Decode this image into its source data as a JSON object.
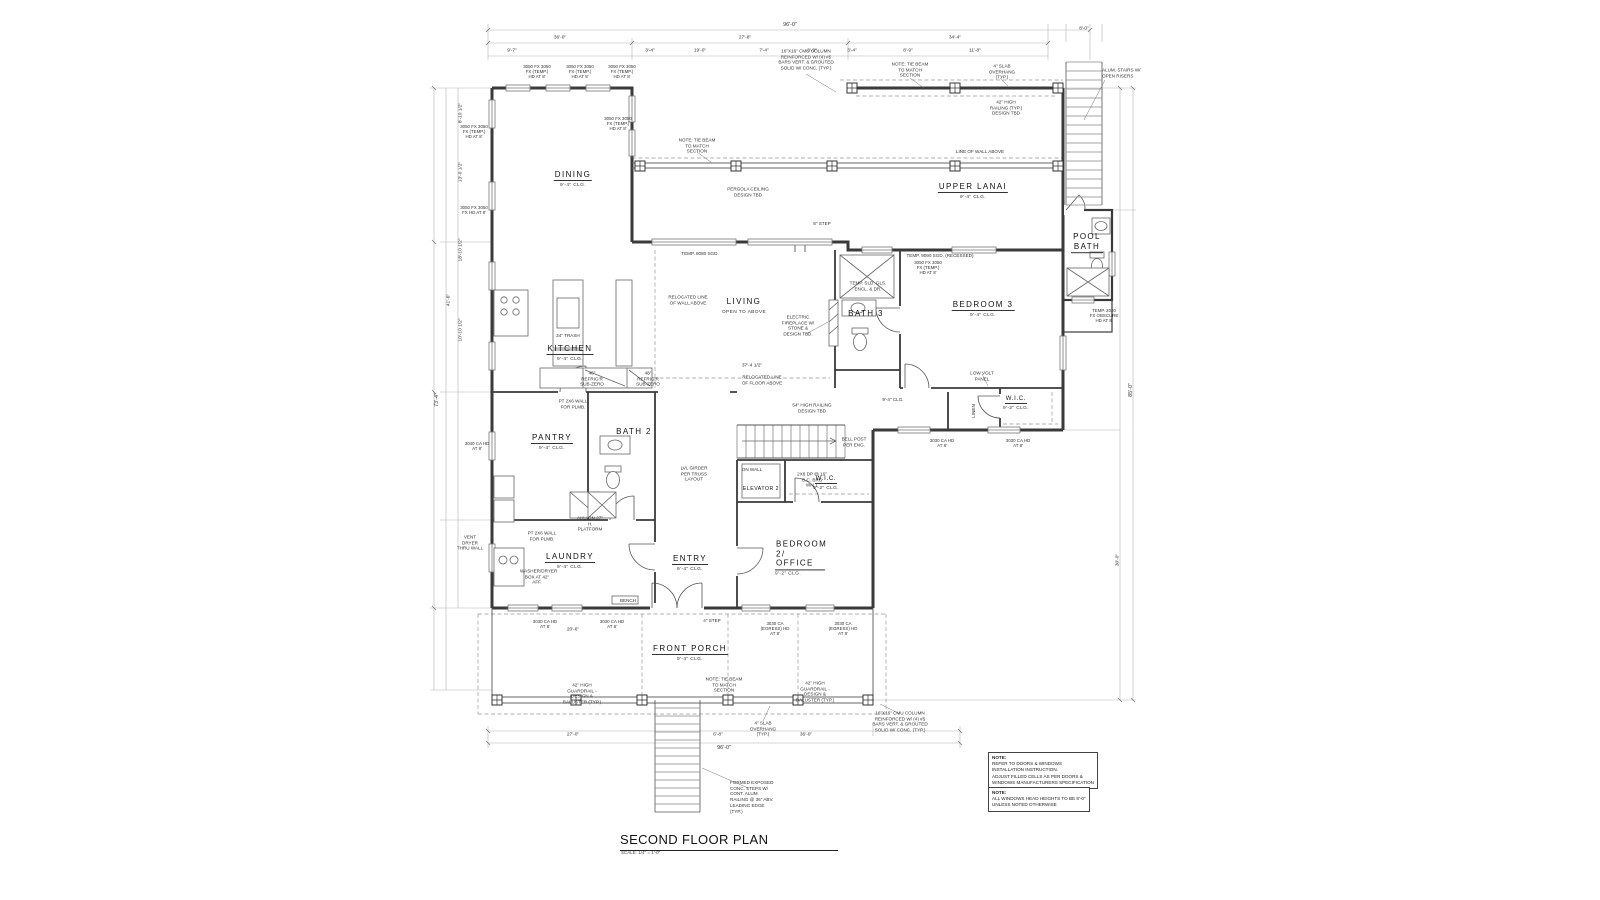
{
  "sheet": {
    "title": "SECOND FLOOR PLAN",
    "scale": "SCALE: 1/4\" = 1'-0\""
  },
  "notes": [
    {
      "heading": "NOTE:",
      "line1": "REFER TO DOORS & WINDOWS INSTALLATION INSTRUCTION.",
      "line2": "ADJUST FILLED CELLS AS PER DOORS & WINDOWS MANUFACTURERS SPECIFICATION"
    },
    {
      "heading": "NOTE:",
      "line1": "ALL WINDOWS HEAD HEIGHTS TO BE 8'-0\" UNLESS NOTED OTHERWISE",
      "line2": ""
    }
  ],
  "rooms": [
    {
      "name": "DINING",
      "detail": "9'-4\" CLG."
    },
    {
      "name": "UPPER LANAI",
      "detail": "9'-4\" CLG."
    },
    {
      "name": "POOL BATH",
      "detail": ""
    },
    {
      "name": "LIVING",
      "detail": "OPEN TO ABOVE"
    },
    {
      "name": "BATH 3",
      "detail": ""
    },
    {
      "name": "BEDROOM 3",
      "detail": "9'-4\" CLG."
    },
    {
      "name": "KITCHEN",
      "detail": "9'-4\" CLG."
    },
    {
      "name": "PANTRY",
      "detail": "9'-4\" CLG."
    },
    {
      "name": "BATH 2",
      "detail": ""
    },
    {
      "name": "LAUNDRY",
      "detail": "9'-4\" CLG."
    },
    {
      "name": "ENTRY",
      "detail": "9'-4\" CLG."
    },
    {
      "name": "ELEVATOR 2",
      "detail": ""
    },
    {
      "name": "W.I.C.",
      "detail": "9'-2\" CLG."
    },
    {
      "name": "BEDROOM 2/ OFFICE",
      "detail": "9'-2\" CLG."
    },
    {
      "name": "W.I.C.",
      "detail": "9'-2\" CLG."
    },
    {
      "name": "FRONT PORCH",
      "detail": "9'-4\" CLG."
    }
  ],
  "annotations": [
    {
      "text": "ALUM. STAIRS W/ OPEN RISERS"
    },
    {
      "text": "16\"X16\" CMU COLUMN REINFORCED W/ (4) #5 BARS VERT. & GROUTED SOLID W/ CONC. (TYP.)"
    },
    {
      "text": "NOTE: TIE BEAM TO MATCH SECTION"
    },
    {
      "text": "4\" SLAB OVERHANG (TYP.)"
    },
    {
      "text": "42\" HIGH RAILING (TYP.) DESIGN TBD"
    },
    {
      "text": "PERGOLA CEILING DESIGN TBD"
    },
    {
      "text": "LINE OF WALL ABOVE"
    },
    {
      "text": "8\" STEP"
    },
    {
      "text": "TEMP. 8080 SGD."
    },
    {
      "text": "TEMP. 9090 SGD. (RECESSED)"
    },
    {
      "text": "RELOCATED LINE OF WALL ABOVE"
    },
    {
      "text": "RELOCATED LINE OF FLOOR ABOVE"
    },
    {
      "text": "ELECTRIC FIREPLACE W/ STONE & DESIGN TBD."
    },
    {
      "text": "TEMP. SLD. GLS. ENCL. & DR."
    },
    {
      "text": "LOW VOLT PANEL"
    },
    {
      "text": "LINEN"
    },
    {
      "text": "54\" HIGH RAILING DESIGN TBD"
    },
    {
      "text": "BELL POST PER ENG."
    },
    {
      "text": "ON WALL"
    },
    {
      "text": "LVL GIRDER PER TRUSS LAYOUT"
    },
    {
      "text": "2X6 DP @ 16\" O.C. BRG WALL"
    },
    {
      "text": "AHU ON 27\" H. PLATFORM"
    },
    {
      "text": "PT 2X6 WALL FOR PLMB."
    },
    {
      "text": "VENT DRYER THRU WALL"
    },
    {
      "text": "WASHER/DRYER BOX AT 42\" AFF."
    },
    {
      "text": "BENCH"
    },
    {
      "text": "4\" STEP"
    },
    {
      "text": "42\" HIGH GUARDRAIL - DESIGN & BALUSTER (TYP.)"
    },
    {
      "text": "FORMED EXPOSED CONC. STEPS W/ CONT. ALUM. RAILING @ 36\" ABV. LEADING EDGE (TYP.)"
    },
    {
      "text": "9'-4\" CLG."
    },
    {
      "text": "24\" TRASH"
    },
    {
      "text": "48\" REFRIG'R SUB-ZERO"
    }
  ],
  "window_tags": [
    {
      "text": "3050 FX 3050 FX (TEMP.) HD AT 8'"
    },
    {
      "text": "3050 FX 3050 FX HD AT 8'"
    },
    {
      "text": "3040 CA HD AT 8'"
    },
    {
      "text": "3030 CA HD AT 8'"
    },
    {
      "text": "3030 CA (EGRESS) HD AT 8'"
    },
    {
      "text": "TEMP. 2020 FX OBSCURE HD AT 8'"
    }
  ],
  "dims": [
    "96'-0\"",
    "36'-0\"",
    "27'-8\"",
    "34'-4\"",
    "73'-4\"",
    "41'-6\"",
    "85'-0\"",
    "30'-0\"",
    "37'-4 1/2\"",
    "20'-6\"",
    "8'-10 1/2\"",
    "13'-0 1/2\"",
    "18'-10 1/2\"",
    "10'-10 1/2\"",
    "9'-7\"",
    "19'-0\"",
    "3'-4\"",
    "7'-4\"",
    "8'-9\"",
    "11'-8\"",
    "6'-8\"",
    "27'-0\"",
    "8'-0\""
  ],
  "colors": {
    "wall": "#3a3a3a",
    "dim_line": "#aaaaaa",
    "text": "#222222",
    "background": "#ffffff"
  }
}
